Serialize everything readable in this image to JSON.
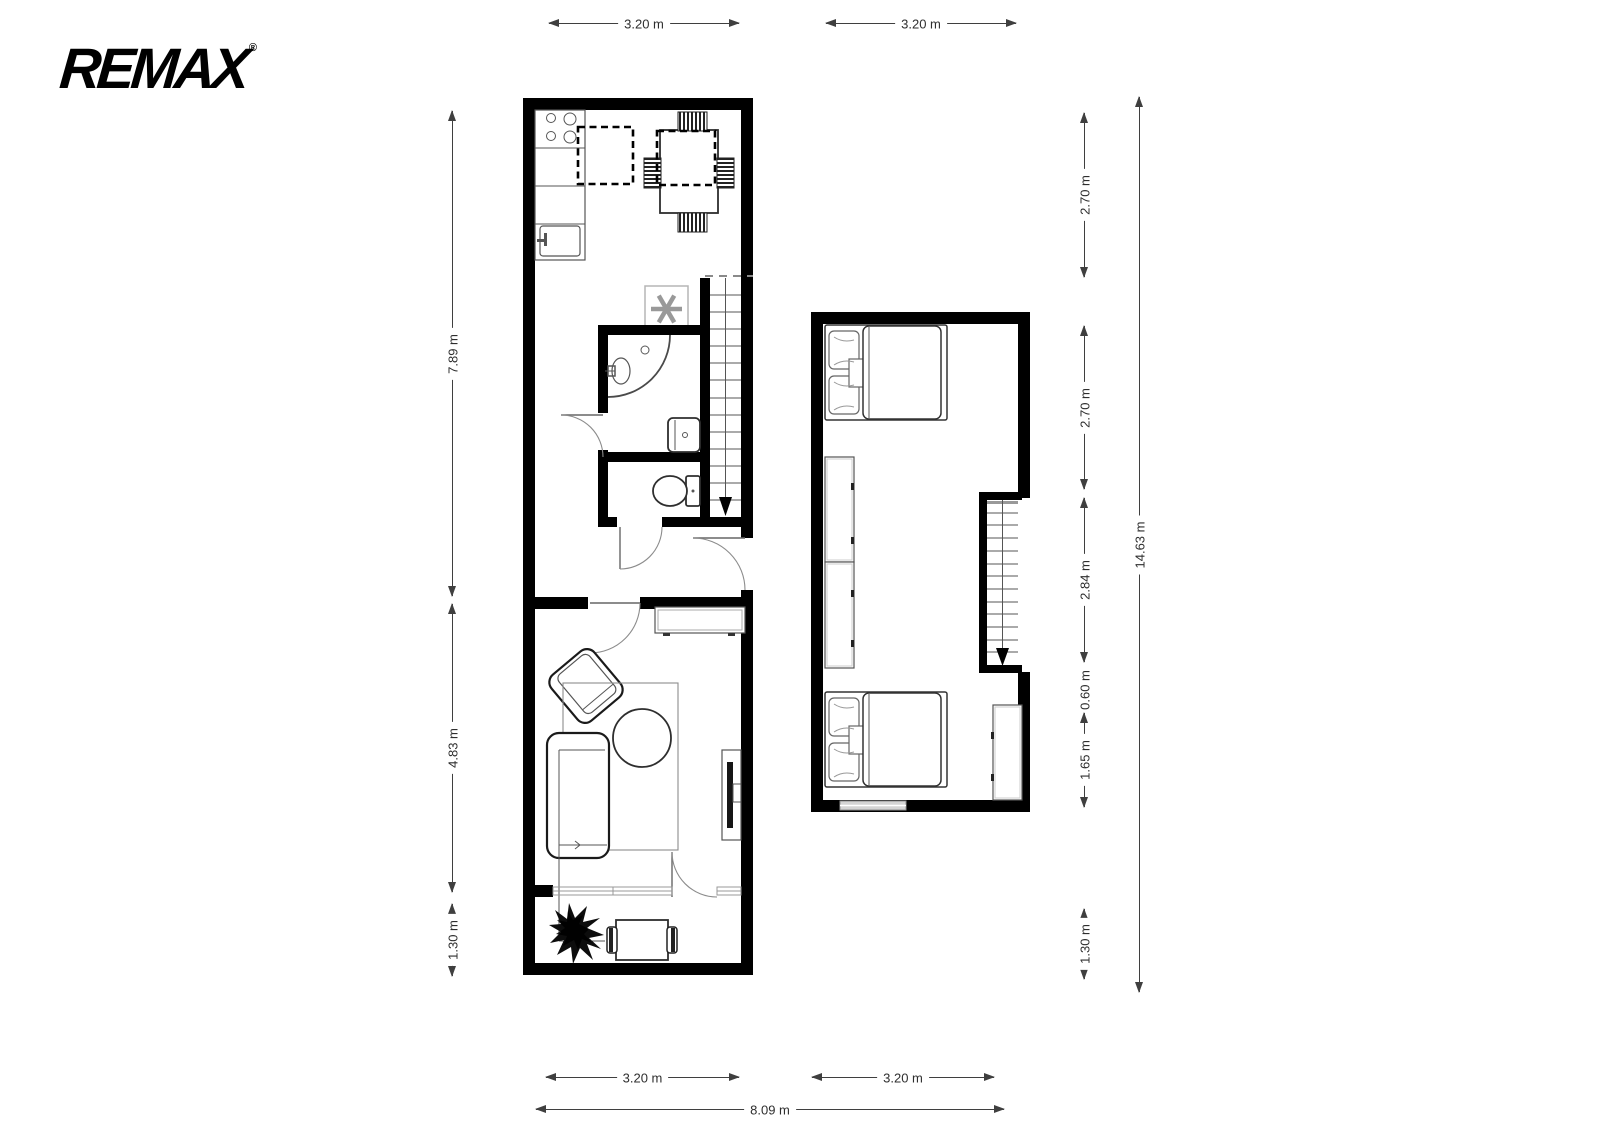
{
  "logo": {
    "brand": "REMAX",
    "registered_mark": "®"
  },
  "floors": {
    "ground_floor": {
      "rooms": [
        "kitchen",
        "bathroom",
        "toilet",
        "hallway",
        "living-room",
        "terrace"
      ],
      "furniture": [
        "stove",
        "kitchen-counter",
        "kitchen-sink",
        "dining-table",
        "dining-chairs",
        "water-heater",
        "staircase",
        "shower",
        "washbasin",
        "washing-machine",
        "toilet",
        "sideboard",
        "armchair",
        "sofa",
        "coffee-table",
        "rug",
        "tv-unit",
        "plant",
        "terrace-table",
        "terrace-chairs"
      ]
    },
    "upper_floor": {
      "rooms": [
        "bedroom-1",
        "bedroom-2"
      ],
      "furniture": [
        "double-bed",
        "wardrobe",
        "wardrobe",
        "staircase",
        "double-bed",
        "wardrobe",
        "window"
      ]
    }
  },
  "dimensions": {
    "ground_top_width": "3.20 m",
    "upper_top_width": "3.20 m",
    "ground_zone1_height": "7.89 m",
    "ground_zone2_height": "4.83 m",
    "ground_zone3_height": "1.30 m",
    "upper_zone1_height": "2.70 m",
    "upper_zone2_height": "2.70 m",
    "upper_zone3_height": "2.84 m",
    "upper_zone4_height": "0.60 m",
    "upper_zone5_height": "1.65 m",
    "upper_zone6_height": "1.30 m",
    "total_height": "14.63 m",
    "ground_bottom_width": "3.20 m",
    "upper_bottom_width": "3.20 m",
    "total_width": "8.09 m"
  },
  "colors": {
    "walls": "#000000",
    "background": "#ffffff",
    "furniture_outline": "#3c3c3c",
    "dimension_lines": "#3f3f3f"
  }
}
